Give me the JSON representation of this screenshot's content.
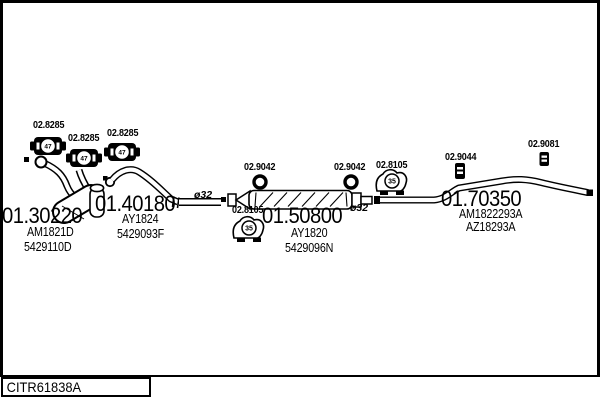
{
  "colors": {
    "ink": "#000000",
    "paper": "#ffffff"
  },
  "footer": {
    "catalog_code": "CITR61838A"
  },
  "diagram": {
    "gaskets": {
      "g1": "02.8285",
      "g2": "02.8285",
      "g3": "02.8285",
      "inner": "47"
    },
    "rings": {
      "r1": "02.9042",
      "r2": "02.9042"
    },
    "hangers": {
      "h1": "02.8105",
      "h2": "02.8105",
      "inner": "35"
    },
    "brackets": {
      "b1": "02.9044",
      "b2": "02.9081"
    },
    "diameters": {
      "d1": "ø32",
      "d2": "ø32"
    },
    "sections": {
      "front_pipe": {
        "ref": "01.30220",
        "type_code": "AM1821D",
        "oe_code": "5429110D"
      },
      "mid_pipe": {
        "ref": "01.40180",
        "type_code": "AY1824",
        "oe_code": "5429093F"
      },
      "silencer": {
        "ref": "01.50800",
        "type_code": "AY1820",
        "oe_code": "5429096N"
      },
      "tail_pipe": {
        "ref": "01.70350",
        "type_code": "AM1822293A",
        "oe_code": "AZ18293A"
      }
    }
  }
}
